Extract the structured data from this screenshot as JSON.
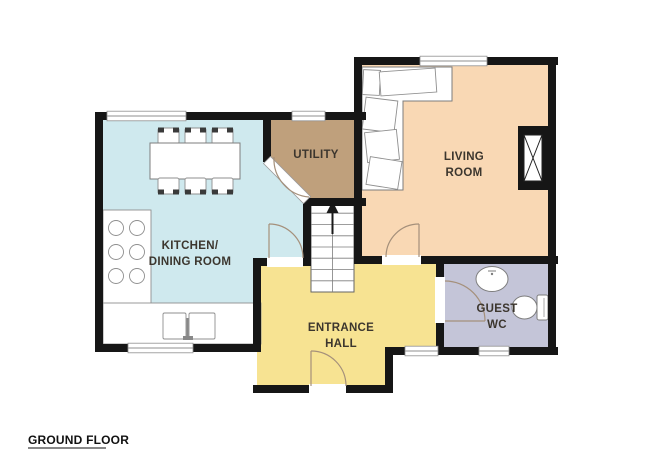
{
  "floor_label": "GROUND FLOOR",
  "rooms": [
    {
      "id": "kitchen-dining-room",
      "line1": "KITCHEN/",
      "line2": "DINING ROOM"
    },
    {
      "id": "utility",
      "line1": "UTILITY",
      "line2": ""
    },
    {
      "id": "living-room",
      "line1": "LIVING",
      "line2": "ROOM"
    },
    {
      "id": "entrance-hall",
      "line1": "ENTRANCE",
      "line2": "HALL"
    },
    {
      "id": "guest-wc",
      "line1": "GUEST",
      "line2": "WC"
    }
  ],
  "colors": {
    "wall": "#161616",
    "kitchen": "#cfe9ee",
    "utility": "#bfa07c",
    "living": "#f9d8b4",
    "hall": "#f7e392",
    "wc": "#c4c5d8",
    "door_arc": "#a5907b",
    "arrow": "#1a1a1a"
  },
  "icons": {
    "stairs_arrow": "arrow-up",
    "fireplace_symbol": "crossed-box",
    "door_symbol": "quarter-arc"
  }
}
